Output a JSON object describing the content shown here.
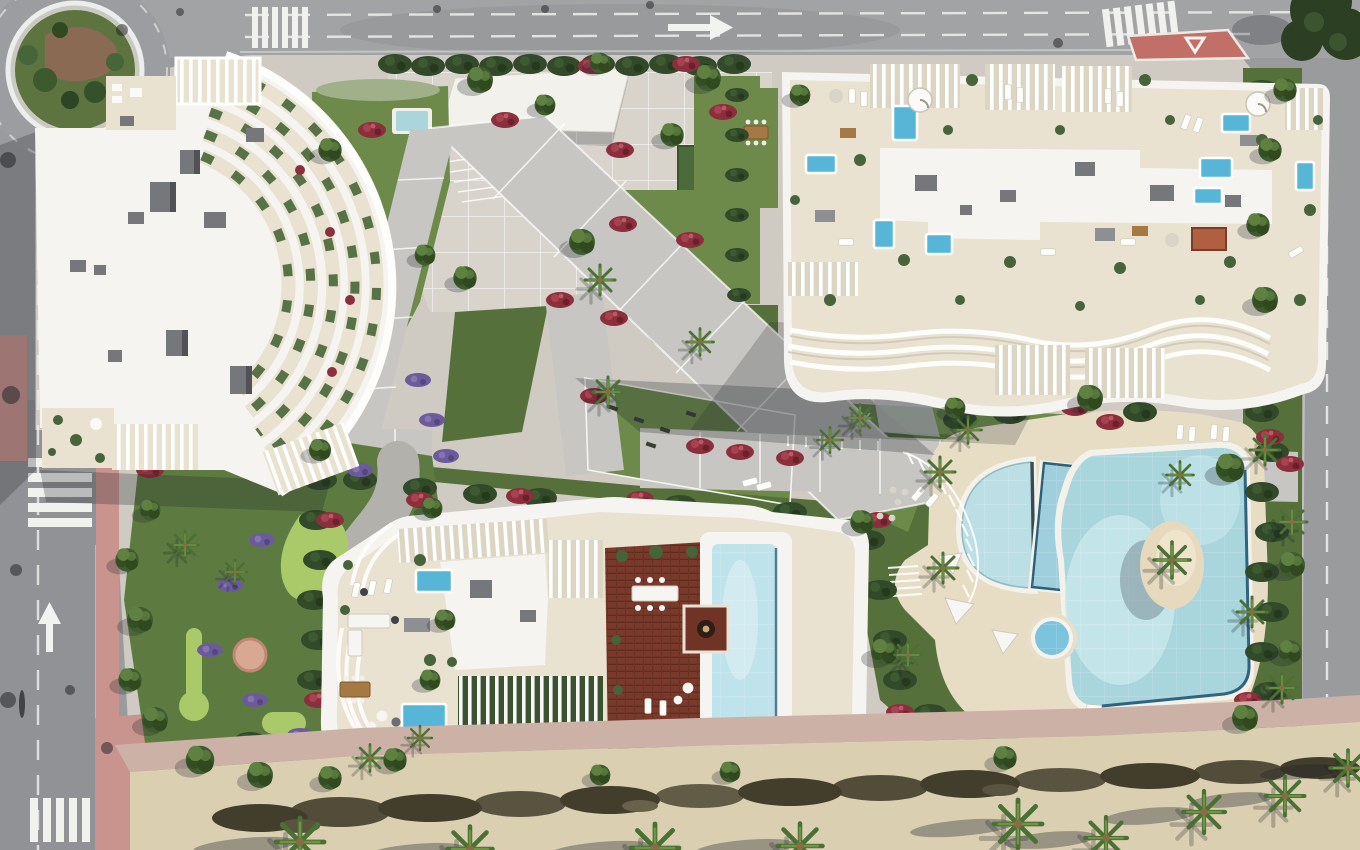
{
  "scene": {
    "title": "Aerial top-down architectural rendering of a coastal residential complex",
    "description": "Bird's-eye render of three white apartment buildings with rooftop terraces and plunge pools, a lagoon-style pool complex with a sand island, mini-golf putting greens, landscaped gardens with palms and flowering shrubs, perimeter roads with a roundabout and crosswalks, and a sandy beach promenade along the bottom edge.",
    "view": "top-down",
    "time_of_day": "midday sun, shadows cast to the lower-left"
  },
  "palette": {
    "asphalt": "#9a9b9d",
    "asphalt_dark": "#85868a",
    "road_line": "#ececea",
    "path": "#cfcbc2",
    "plaza": "#d8d4cb",
    "walkway": "#c7c6c2",
    "lawn": "#6d8a4b",
    "lawn_dark": "#55703a",
    "golf_green": "#5d7b40",
    "putting_green": "#aac968",
    "hedge": "#32492a",
    "tree": "#3f5c30",
    "tree_light": "#5e8040",
    "palm": "#4b7034",
    "sand": "#dbcfb2",
    "sand_scrub": "#433d2b",
    "pink_pavement": "#c9948e",
    "traffic_island_red": "#c26f68",
    "flowers_red": "#8c2f3c",
    "flowers_purple": "#6c5b9a",
    "roof_white": "#f5f4f0",
    "roof_shade": "#dddad2",
    "terrace_beige": "#eae2d1",
    "rooftop_unit_gray": "#75777b",
    "pool_water": "#a9d5dc",
    "pool_water_light": "#c8e8ec",
    "plunge_pool_blue": "#57b5d8",
    "pool_dark_rim": "#2f6480",
    "wood_deck": "#7a3a2b",
    "wood_deck_dark": "#602d20",
    "shadow": "rgba(30,34,44,0.26)"
  },
  "features": {
    "roads": {
      "roundabout": "landscaped roundabout at top-left corner",
      "crosswalk_count": 4,
      "lane_markings": "dashed white lane lines with directional arrows",
      "traffic_island": "red painted island at top-right junction"
    },
    "buildings": [
      {
        "id": "building-northwest",
        "style": "white roof slab with cascading curved balcony fins and slatted pergolas",
        "rooftop": "HVAC units and terraces"
      },
      {
        "id": "building-northeast",
        "style": "rounded slab with scalloped wavy balconies",
        "rooftop": "beige terraces, many plunge pools, pergola slats, central white roof"
      },
      {
        "id": "building-south",
        "style": "organic curved outline",
        "rooftop": "wooden deck, long lap pool, pergola rows, lounge terraces"
      }
    ],
    "amenities": [
      "lagoon pool with palm sand island",
      "diagonal lap pool",
      "half-moon leisure pool",
      "round jacuzzi",
      "mini-golf putting greens",
      "outdoor gym lawn",
      "sun loungers and shade sails",
      "beach promenade with dune scrub"
    ],
    "landscape": [
      "lawns",
      "palm trees",
      "round canopy trees",
      "red flowering shrubs",
      "purple flowering borders",
      "trimmed hedges",
      "sand strip with palm shadows"
    ]
  }
}
